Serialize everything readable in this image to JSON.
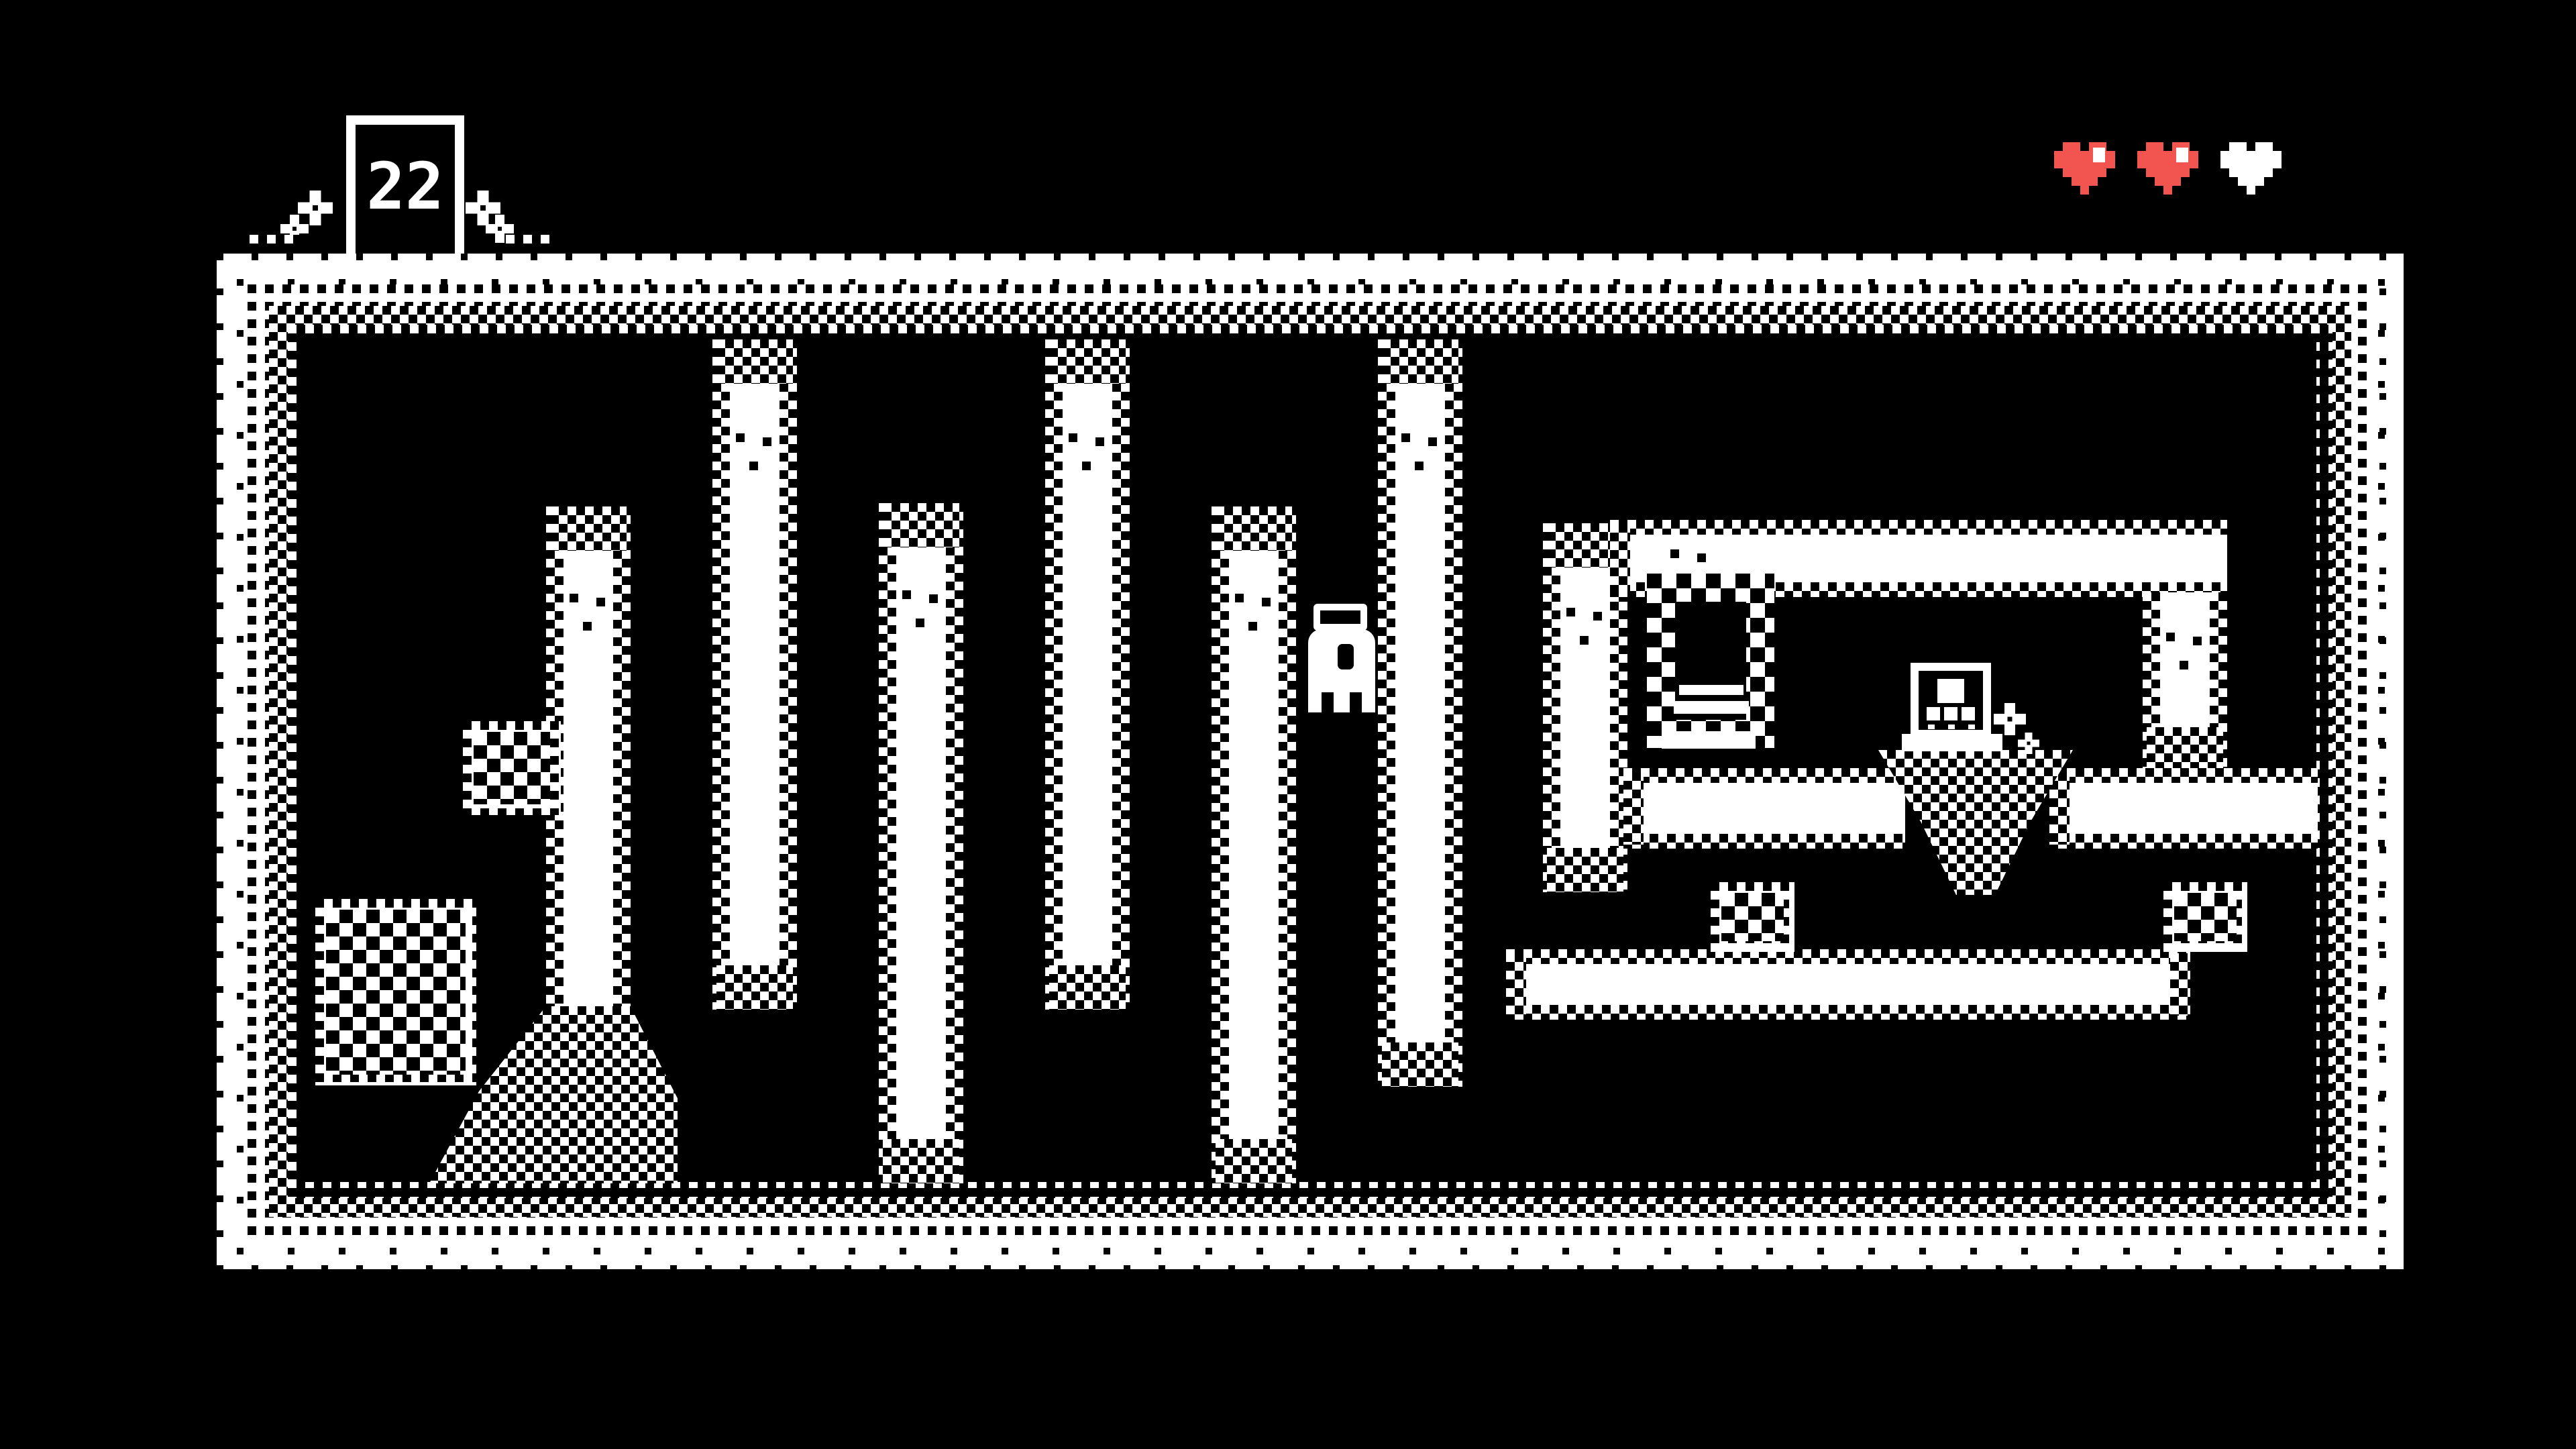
{
  "game": {
    "style": "1-bit dithered pixel adventure room",
    "background_color": "#000000",
    "foreground_color": "#FFFFFF"
  },
  "hud": {
    "counter": {
      "value": "22",
      "meaning": "counter shown on a white-framed sign standing on the top wall"
    },
    "hearts": {
      "total": 3,
      "full": 2,
      "empty": 1,
      "full_color": "#F2544F",
      "empty_color": "#FFFFFF",
      "highlight_color": "#FFFFFF"
    }
  },
  "scene": {
    "player": "small white hooded character with black eye, standing in middle corridor",
    "structures": [
      "dither-stippled outer wall border surrounding black room",
      "six vertical white pillars with checkered dither edges forming a maze",
      "walled alcove on the right with top beam and hanging pillar",
      "checker-framed doorway with two white steps",
      "shrine box with white eye square and three small squares, on pedestal over dithered mound",
      "checker-filled blocks and dithered ramp near walls",
      "long white beams with dithered edges"
    ],
    "decorations": [
      "pixel flowers beside the counter sign",
      "pixel flower beside the shrine"
    ]
  }
}
